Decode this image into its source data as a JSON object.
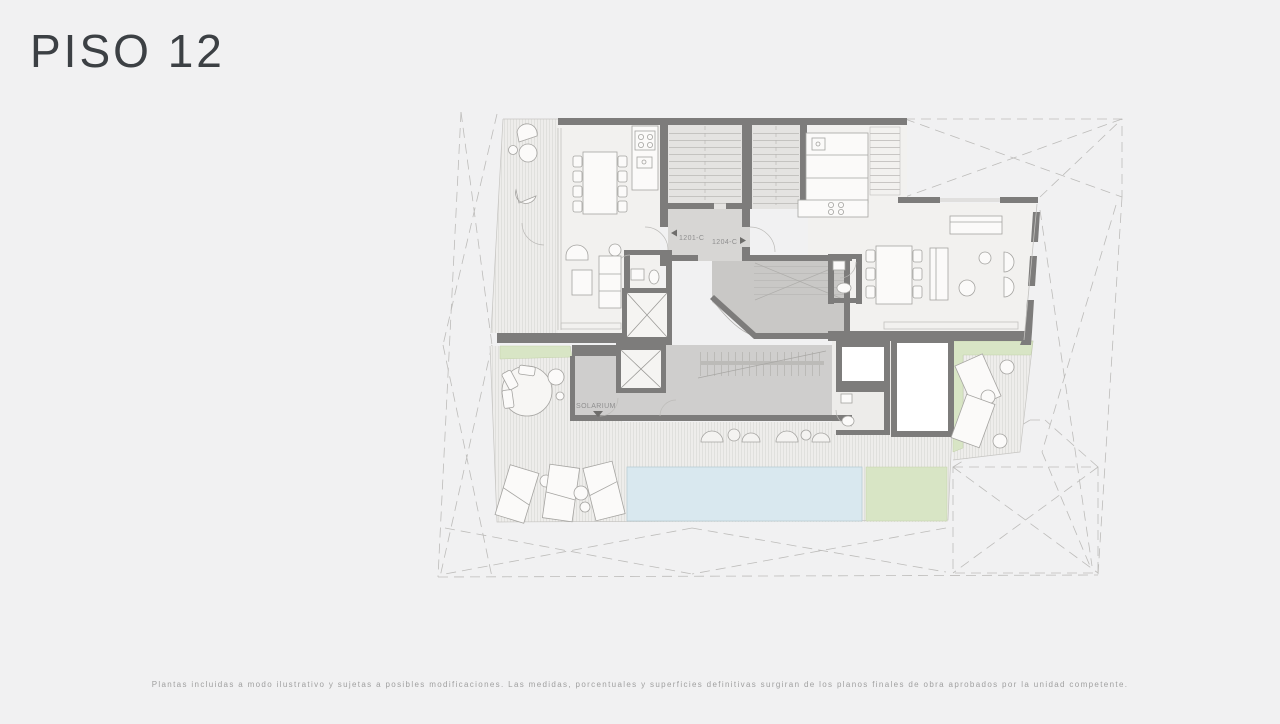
{
  "title": "PISO 12",
  "plan": {
    "units": [
      {
        "label": "1201-C",
        "direction": "left"
      },
      {
        "label": "1204-C",
        "direction": "right"
      }
    ],
    "areas": {
      "solarium_label": "SOLARIUM"
    },
    "colors": {
      "background": "#f1f1f2",
      "wall": "#7d7c7b",
      "pool": "#d9e8ef",
      "lawn": "#d8e5c5",
      "core_floor": "#cfcecd",
      "hatch_line": "#d9d8d5"
    }
  },
  "footer": {
    "disclaimer": "Plantas incluidas a modo ilustrativo y sujetas a posibles modificaciones. Las medidas, porcentuales y superficies definitivas surgiran de los planos finales de obra aprobados por la unidad competente."
  }
}
